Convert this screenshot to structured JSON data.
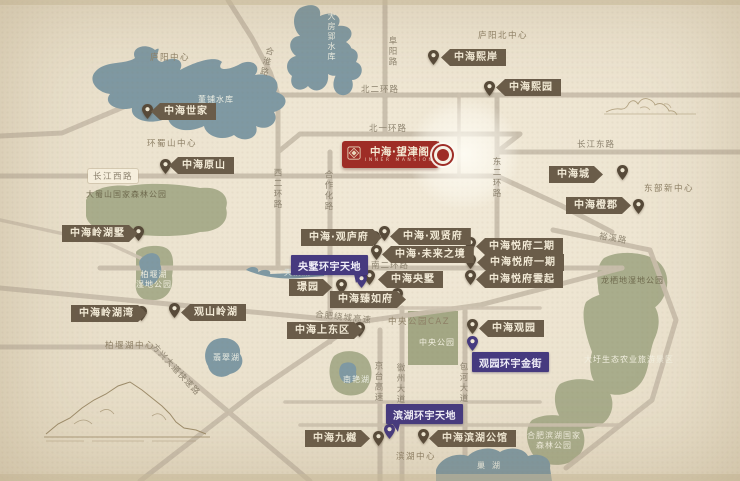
{
  "badge": {
    "title": "中海·望津阁",
    "subtitle": "INNER MANSION",
    "color": "#9e2d26"
  },
  "projects": [
    "中海世家",
    "中海原山",
    "中海熙岸",
    "中海熙园",
    "中海城",
    "中海橙郡",
    "中海·观庐府",
    "中海·观贤府",
    "中海·未来之境",
    "中海央墅",
    "璟园",
    "中海臻如府",
    "中海悦府二期",
    "中海悦府一期",
    "中海悦府雲起",
    "中海观园",
    "中海上东区",
    "中海岭湖墅",
    "中海岭湖湾",
    "观山岭湖",
    "中海九樾",
    "中海滨湖公馆"
  ],
  "commercial": [
    "央墅环宇天地",
    "观园环宇金街",
    "滨湖环宇天地"
  ],
  "roads": [
    "北二环路",
    "北一环路",
    "长江东路",
    "长江西路",
    "南二环路",
    "裕溪路",
    "阜阳路",
    "合淮路",
    "西二环路",
    "东二环路",
    "合作化路",
    "京台高速",
    "徽州大道",
    "包河大道",
    "方兴大道快速路",
    "合肥绕城高速"
  ],
  "districts": [
    "庐阳中心",
    "庐阳北中心",
    "环蜀山中心",
    "东部新中心",
    "中央公园CAZ",
    "柏堰湖中心",
    "滨湖中心"
  ],
  "waters": [
    "董铺水库",
    "大房郢水库",
    "天鹅湖",
    "翡翠湖",
    "南艳湖",
    "巢湖"
  ],
  "parks": [
    "大蜀山国家森林公园",
    "柏堰湖\n湿地公园",
    "中央公园",
    "龙栖地湿地公园",
    "大圩生态农业旅游景区",
    "合肥滨湖国家\n森林公园"
  ],
  "colors": {
    "paper": "#ebe2ce",
    "water": "#7f99a3",
    "park": "#a9ad8c",
    "road": "#c9beac",
    "pill": "#6a5c49",
    "commercial_purple": "#463a7f",
    "badge_red": "#9e2d26"
  }
}
